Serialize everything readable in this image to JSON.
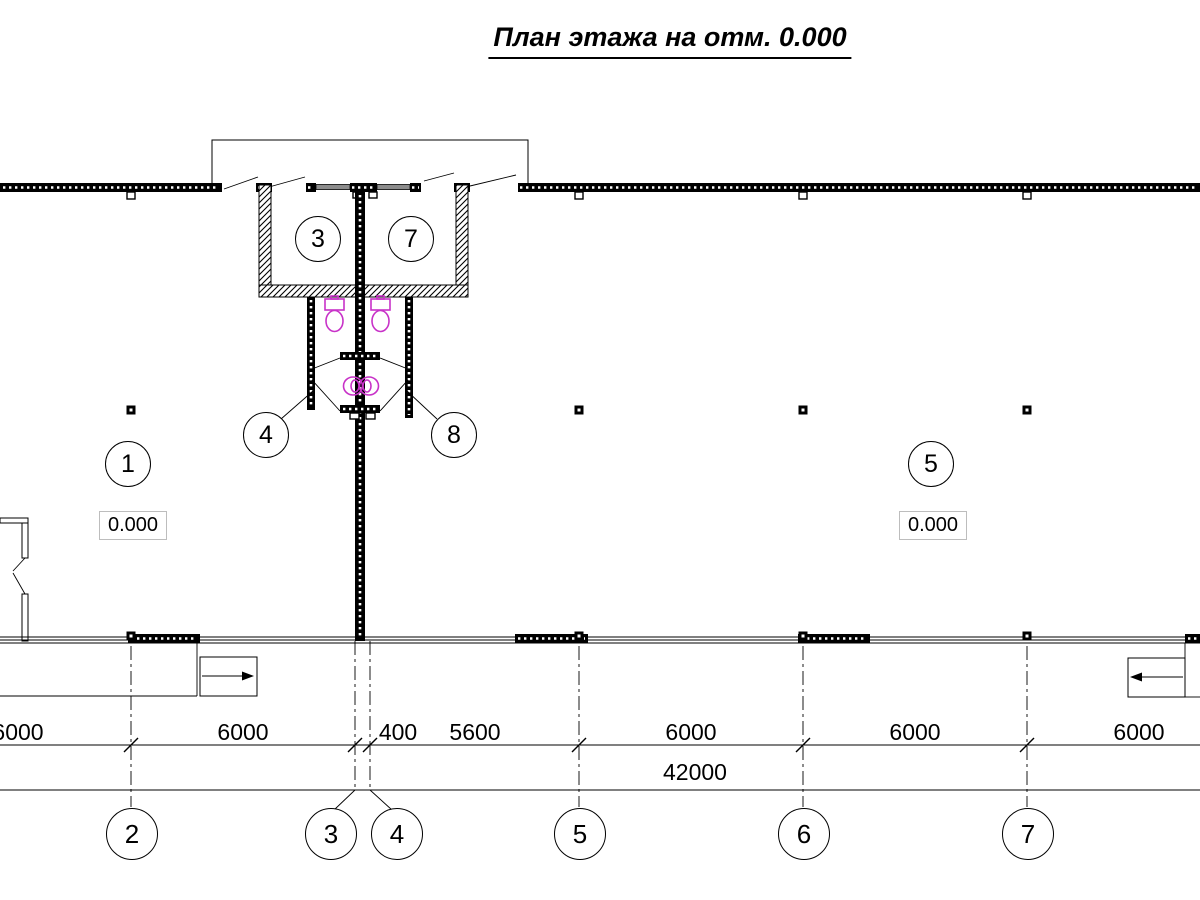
{
  "title": "План этажа на отм. 0.000",
  "rooms": [
    {
      "number": "3"
    },
    {
      "number": "7"
    },
    {
      "number": "4"
    },
    {
      "number": "8"
    },
    {
      "number": "1"
    },
    {
      "number": "5"
    }
  ],
  "elevations": [
    "0.000",
    "0.000"
  ],
  "dimensions": {
    "row1": [
      "6000",
      "6000",
      "400",
      "5600",
      "6000",
      "6000",
      "6000"
    ],
    "overall": "42000"
  },
  "axes": [
    "2",
    "3",
    "4",
    "5",
    "6",
    "7"
  ],
  "icons": [
    "toilet-icon",
    "sink-icon",
    "stair-direction-arrow",
    "door-swing-line",
    "column-marker"
  ],
  "colors": {
    "ink": "#000000",
    "plumbing": "#c832c8"
  }
}
